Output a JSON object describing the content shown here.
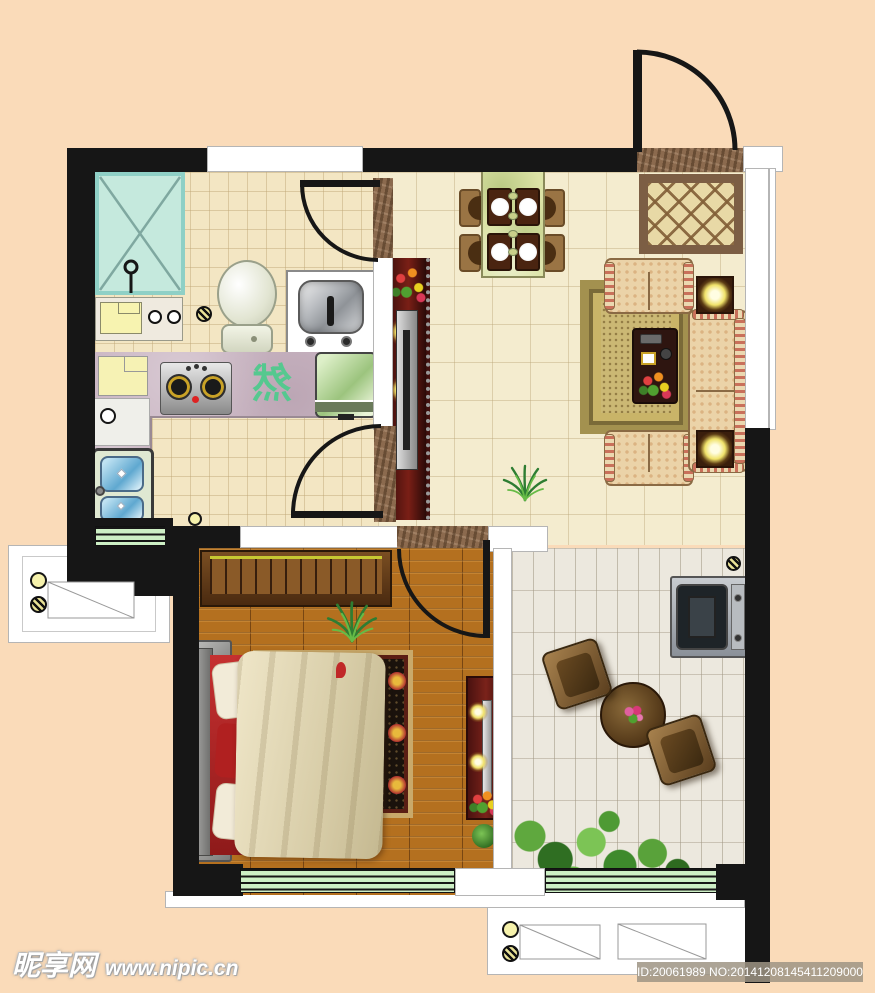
{
  "meta": {
    "type": "apartment-floor-plan"
  },
  "watermark": {
    "site_name": "昵享网",
    "site_url": "www.nipic.cn",
    "id_text": "ID:20061989 NO:20141208145411209000"
  },
  "kitchen": {
    "counter_glyph": "然"
  },
  "palette": {
    "background": "#FADBB9",
    "wall": "#161616",
    "bath_kitchen_tile": "#F3E6C3",
    "living_marble": "#F4ECCF",
    "bedroom_wood": "#B4701F",
    "balcony_brick": "#ECE8DE",
    "kitchen_counter": "#CBB7C4",
    "shower_tray": "#C5E9DD",
    "window_green": "#CDEFC5",
    "sofa_fabric": "#EBD3A8",
    "cabinet_red": "#5C1512",
    "bed_red": "#C53030",
    "blanket_cream": "#EFE6C8",
    "glyph_green": "#55C88F"
  },
  "rooms": [
    "bathroom",
    "kitchen",
    "dining-area",
    "living-room",
    "entry",
    "bedroom",
    "balcony"
  ],
  "furniture": [
    "shower-tray",
    "toilet",
    "washbasin",
    "vanity-counter",
    "gas-stove",
    "cutting-board",
    "kitchen-sink",
    "countertop-appliance",
    "dining-table",
    "dining-chairs",
    "entry-doormat",
    "entry-rug",
    "tv-cabinet",
    "television",
    "sofa-main",
    "loveseat-top",
    "loveseat-bottom",
    "living-rug",
    "coffee-table",
    "lamp-tables",
    "floor-plants",
    "wardrobe",
    "double-bed",
    "pillows",
    "blanket",
    "bedroom-rug",
    "nightstands",
    "dresser",
    "washing-machine",
    "round-tea-table",
    "rattan-chairs",
    "garden-shrubs",
    "floor-drains",
    "ac-platforms",
    "windows",
    "door-arcs"
  ]
}
